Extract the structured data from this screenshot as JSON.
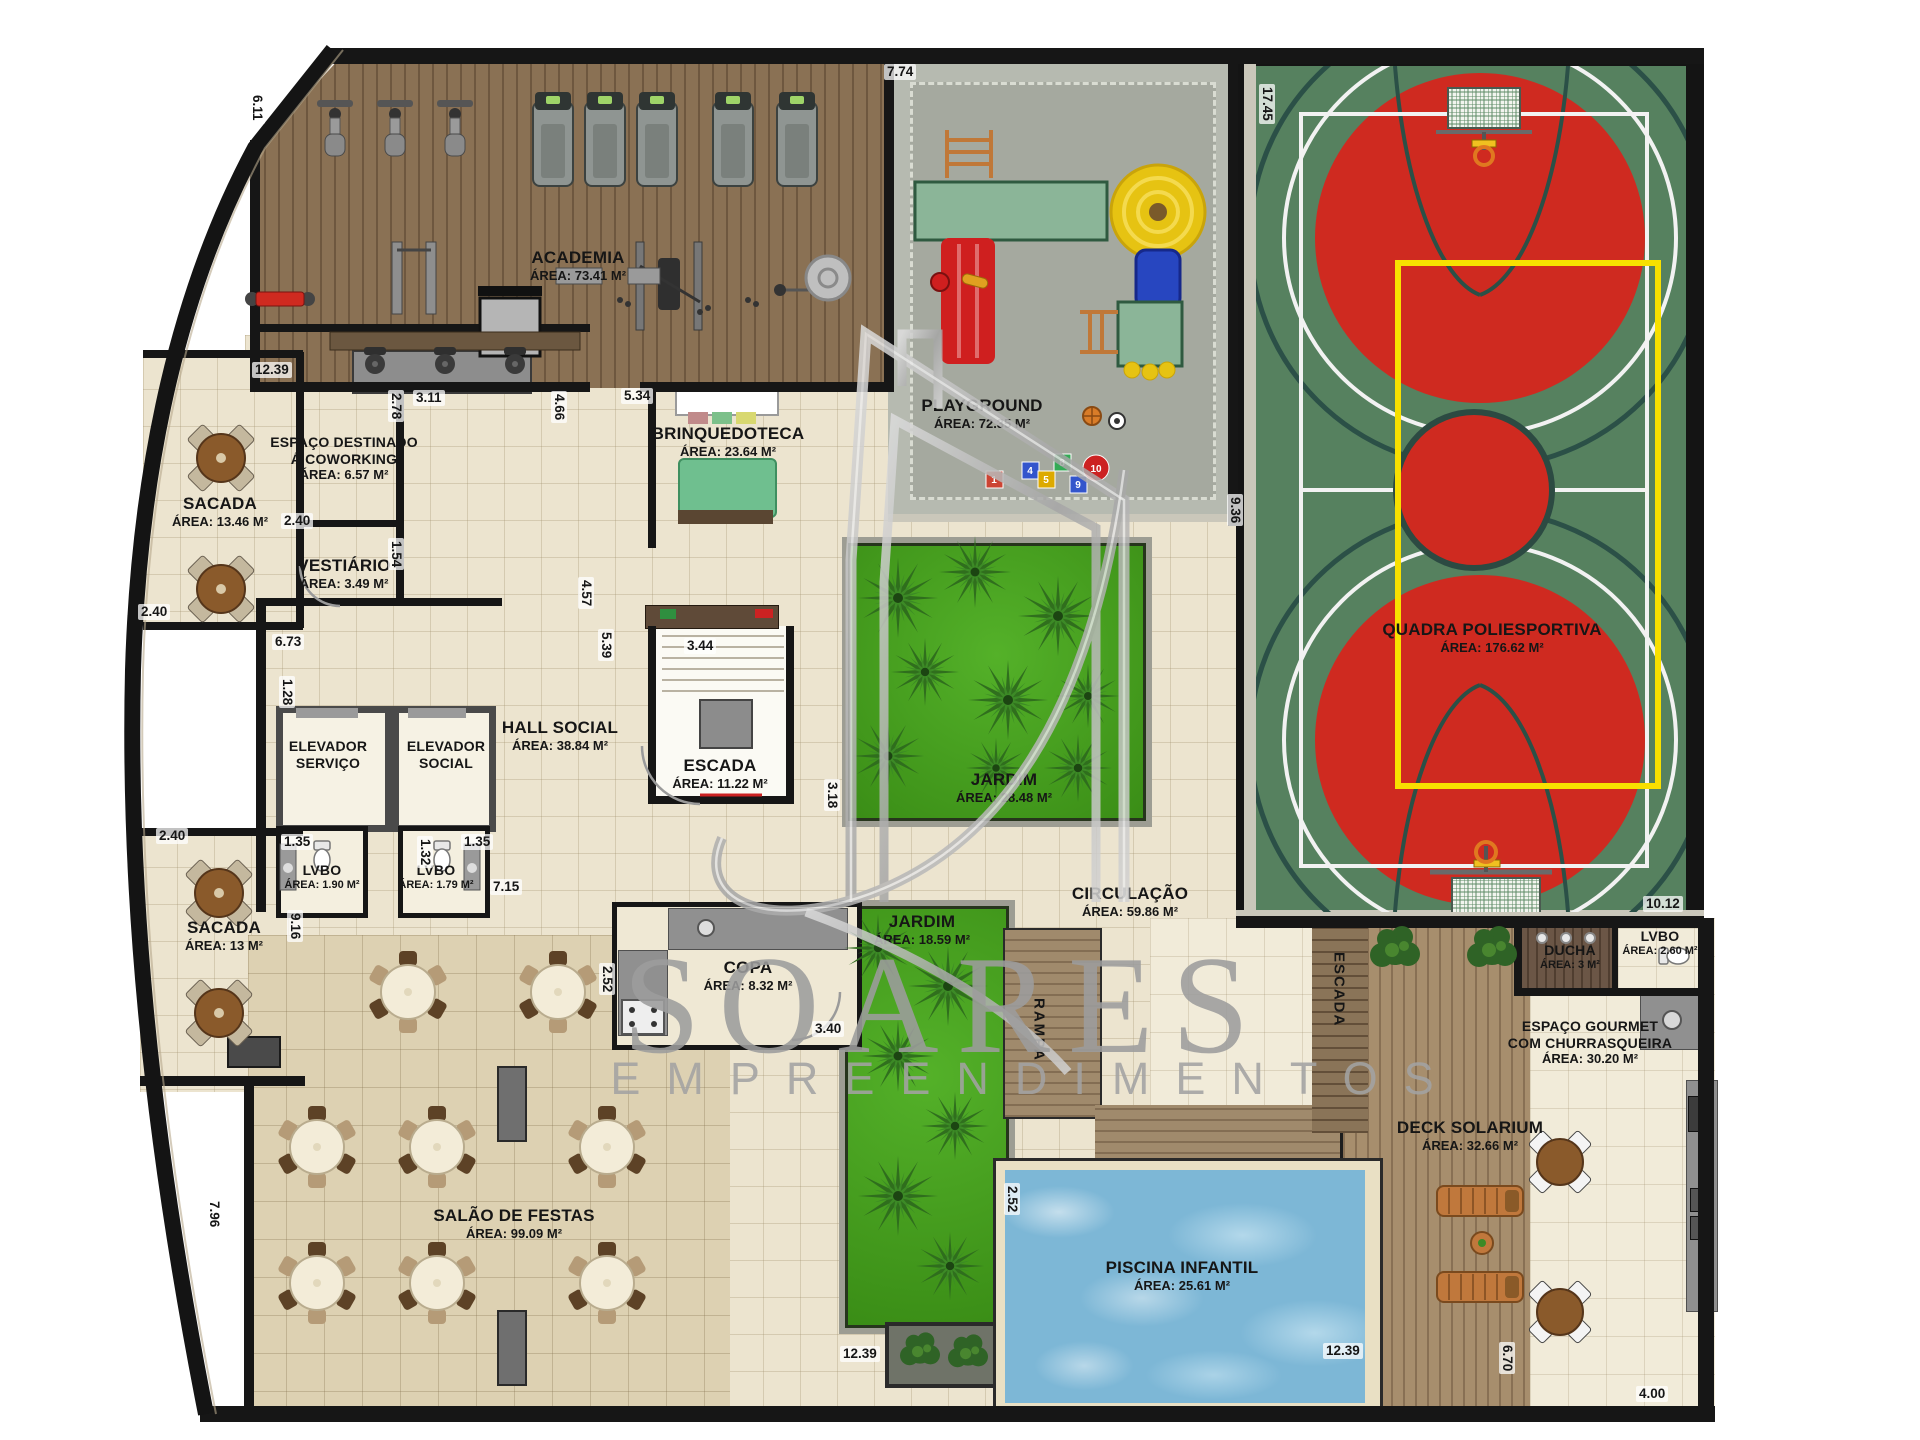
{
  "watermark": {
    "brand": "SOARES",
    "subtitle": "EMPREENDIMENTOS"
  },
  "rooms": {
    "academia": {
      "name": "ACADEMIA",
      "area": "ÁREA: 73.41 M²"
    },
    "playground": {
      "name": "PLAYGROUND",
      "area": "ÁREA: 72.35 M²"
    },
    "quadra": {
      "name": "QUADRA POLIESPORTIVA",
      "area": "ÁREA: 176.62 M²"
    },
    "sacada1": {
      "name": "SACADA",
      "area": "ÁREA: 13.46 M²"
    },
    "coworking": {
      "name": "ESPAÇO DESTINADO",
      "name2": "Á COWORKING",
      "area": "ÁREA: 6.57 M²"
    },
    "vestiario": {
      "name": "VESTIÁRIO",
      "area": "ÁREA: 3.49 M²"
    },
    "brinquedoteca": {
      "name": "BRINQUEDOTECA",
      "area": "ÁREA: 23.64 M²"
    },
    "hall_social": {
      "name": "HALL SOCIAL",
      "area": "ÁREA: 38.84 M²"
    },
    "escada1": {
      "name": "ESCADA",
      "area": "ÁREA: 11.22 M²"
    },
    "elevador_servico": {
      "name": "ELEVADOR",
      "name2": "SERVIÇO"
    },
    "elevador_social": {
      "name": "ELEVADOR",
      "name2": "SOCIAL"
    },
    "lvbo1": {
      "name": "LVBO",
      "area": "ÁREA: 1.90 M²"
    },
    "lvbo2": {
      "name": "LVBO",
      "area": "ÁREA: 1.79 M²"
    },
    "sacada2": {
      "name": "SACADA",
      "area": "ÁREA: 13 M²"
    },
    "jardim1": {
      "name": "JARDIM",
      "area": "ÁREA: 28.48 M²"
    },
    "circulacao": {
      "name": "CIRCULAÇÃO",
      "area": "ÁREA: 59.86 M²"
    },
    "jardim2": {
      "name": "JARDIM",
      "area": "ÁREA: 18.59 M²"
    },
    "copa": {
      "name": "COPA",
      "area": "ÁREA: 8.32 M²"
    },
    "salao": {
      "name": "SALÃO DE FESTAS",
      "area": "ÁREA: 99.09 M²"
    },
    "piscina": {
      "name": "PISCINA INFANTIL",
      "area": "ÁREA: 25.61 M²"
    },
    "deck": {
      "name": "DECK SOLARIUM",
      "area": "ÁREA: 32.66 M²"
    },
    "ducha": {
      "name": "DUCHA",
      "area": "ÁREA: 3 M²"
    },
    "lvbo3": {
      "name": "LVBO",
      "area": "ÁREA: 2.60 M²"
    },
    "gourmet": {
      "name": "ESPAÇO GOURMET",
      "name2": "COM CHURRASQUEIRA",
      "area": "ÁREA: 30.20 M²"
    },
    "rampa": {
      "name": "RAMPA"
    },
    "escada2": {
      "name": "ESCADA"
    }
  },
  "dims": [
    "6.11",
    "12.39",
    "2.78",
    "3.11",
    "4.66",
    "5.34",
    "7.74",
    "17.45",
    "9.36",
    "2.40",
    "2.40",
    "1.54",
    "6.73",
    "1.28",
    "4.57",
    "5.39",
    "3.44",
    "3.18",
    "1.35",
    "1.32",
    "1.35",
    "7.15",
    "9.16",
    "2.40",
    "7.96",
    "2.52",
    "3.40",
    "2.52",
    "12.39",
    "12.39",
    "10.12",
    "6.70",
    "4.00"
  ],
  "playground_tiles": [
    "1",
    "4",
    "5",
    "8",
    "9",
    "10"
  ],
  "colors": {
    "wood": "#8a7154",
    "tile": "#ece4cf",
    "court_green": "#56815f",
    "marking_red": "#cf2a20",
    "marking_yellow": "#f8e000",
    "grass": "#3e9a1b",
    "water": "#7db7d6",
    "concrete": "#b6bab0",
    "watermark_silver": "#9d9d9d"
  }
}
